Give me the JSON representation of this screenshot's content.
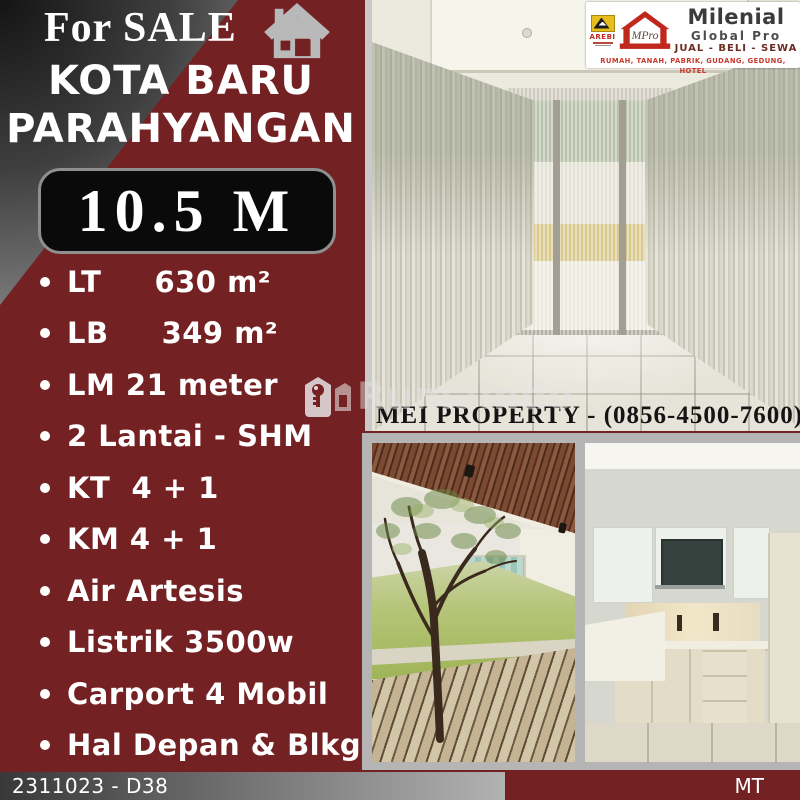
{
  "header": {
    "for_sale": "For SALE",
    "location_line1": "KOTA BARU",
    "location_line2": "PARAHYANGAN",
    "price": "10.5 M"
  },
  "features": [
    "LT     630 m²",
    "LB     349 m²",
    "LM 21 meter",
    "2 Lantai - SHM",
    "KT  4 + 1",
    "KM 4 + 1",
    "Air Artesis",
    "Listrik 3500w",
    "Carport 4 Mobil",
    "Hal Depan & Blkg"
  ],
  "agency": {
    "arebi_label": "AREBI",
    "mpro_label": "MPro",
    "brand": "Milenial",
    "brand_sub": "Global Pro",
    "services": "JUAL - BELI - SEWA",
    "categories": "RUMAH, TANAH, PABRIK, GUDANG, GEDUNG, HOTEL"
  },
  "contact": {
    "text": "MEI PROPERTY - (0856-4500-7600)"
  },
  "watermark": {
    "text": "Rumaindo"
  },
  "footer": {
    "listing_id": "2311023 - D38",
    "agent_initials": "MT"
  },
  "colors": {
    "maroon": "#742123",
    "price_box_bg": "#0a0a0a",
    "arebi_yellow": "#e6bf1c",
    "brand_red": "#c0281e",
    "frame_gray": "#b5b5b5"
  }
}
